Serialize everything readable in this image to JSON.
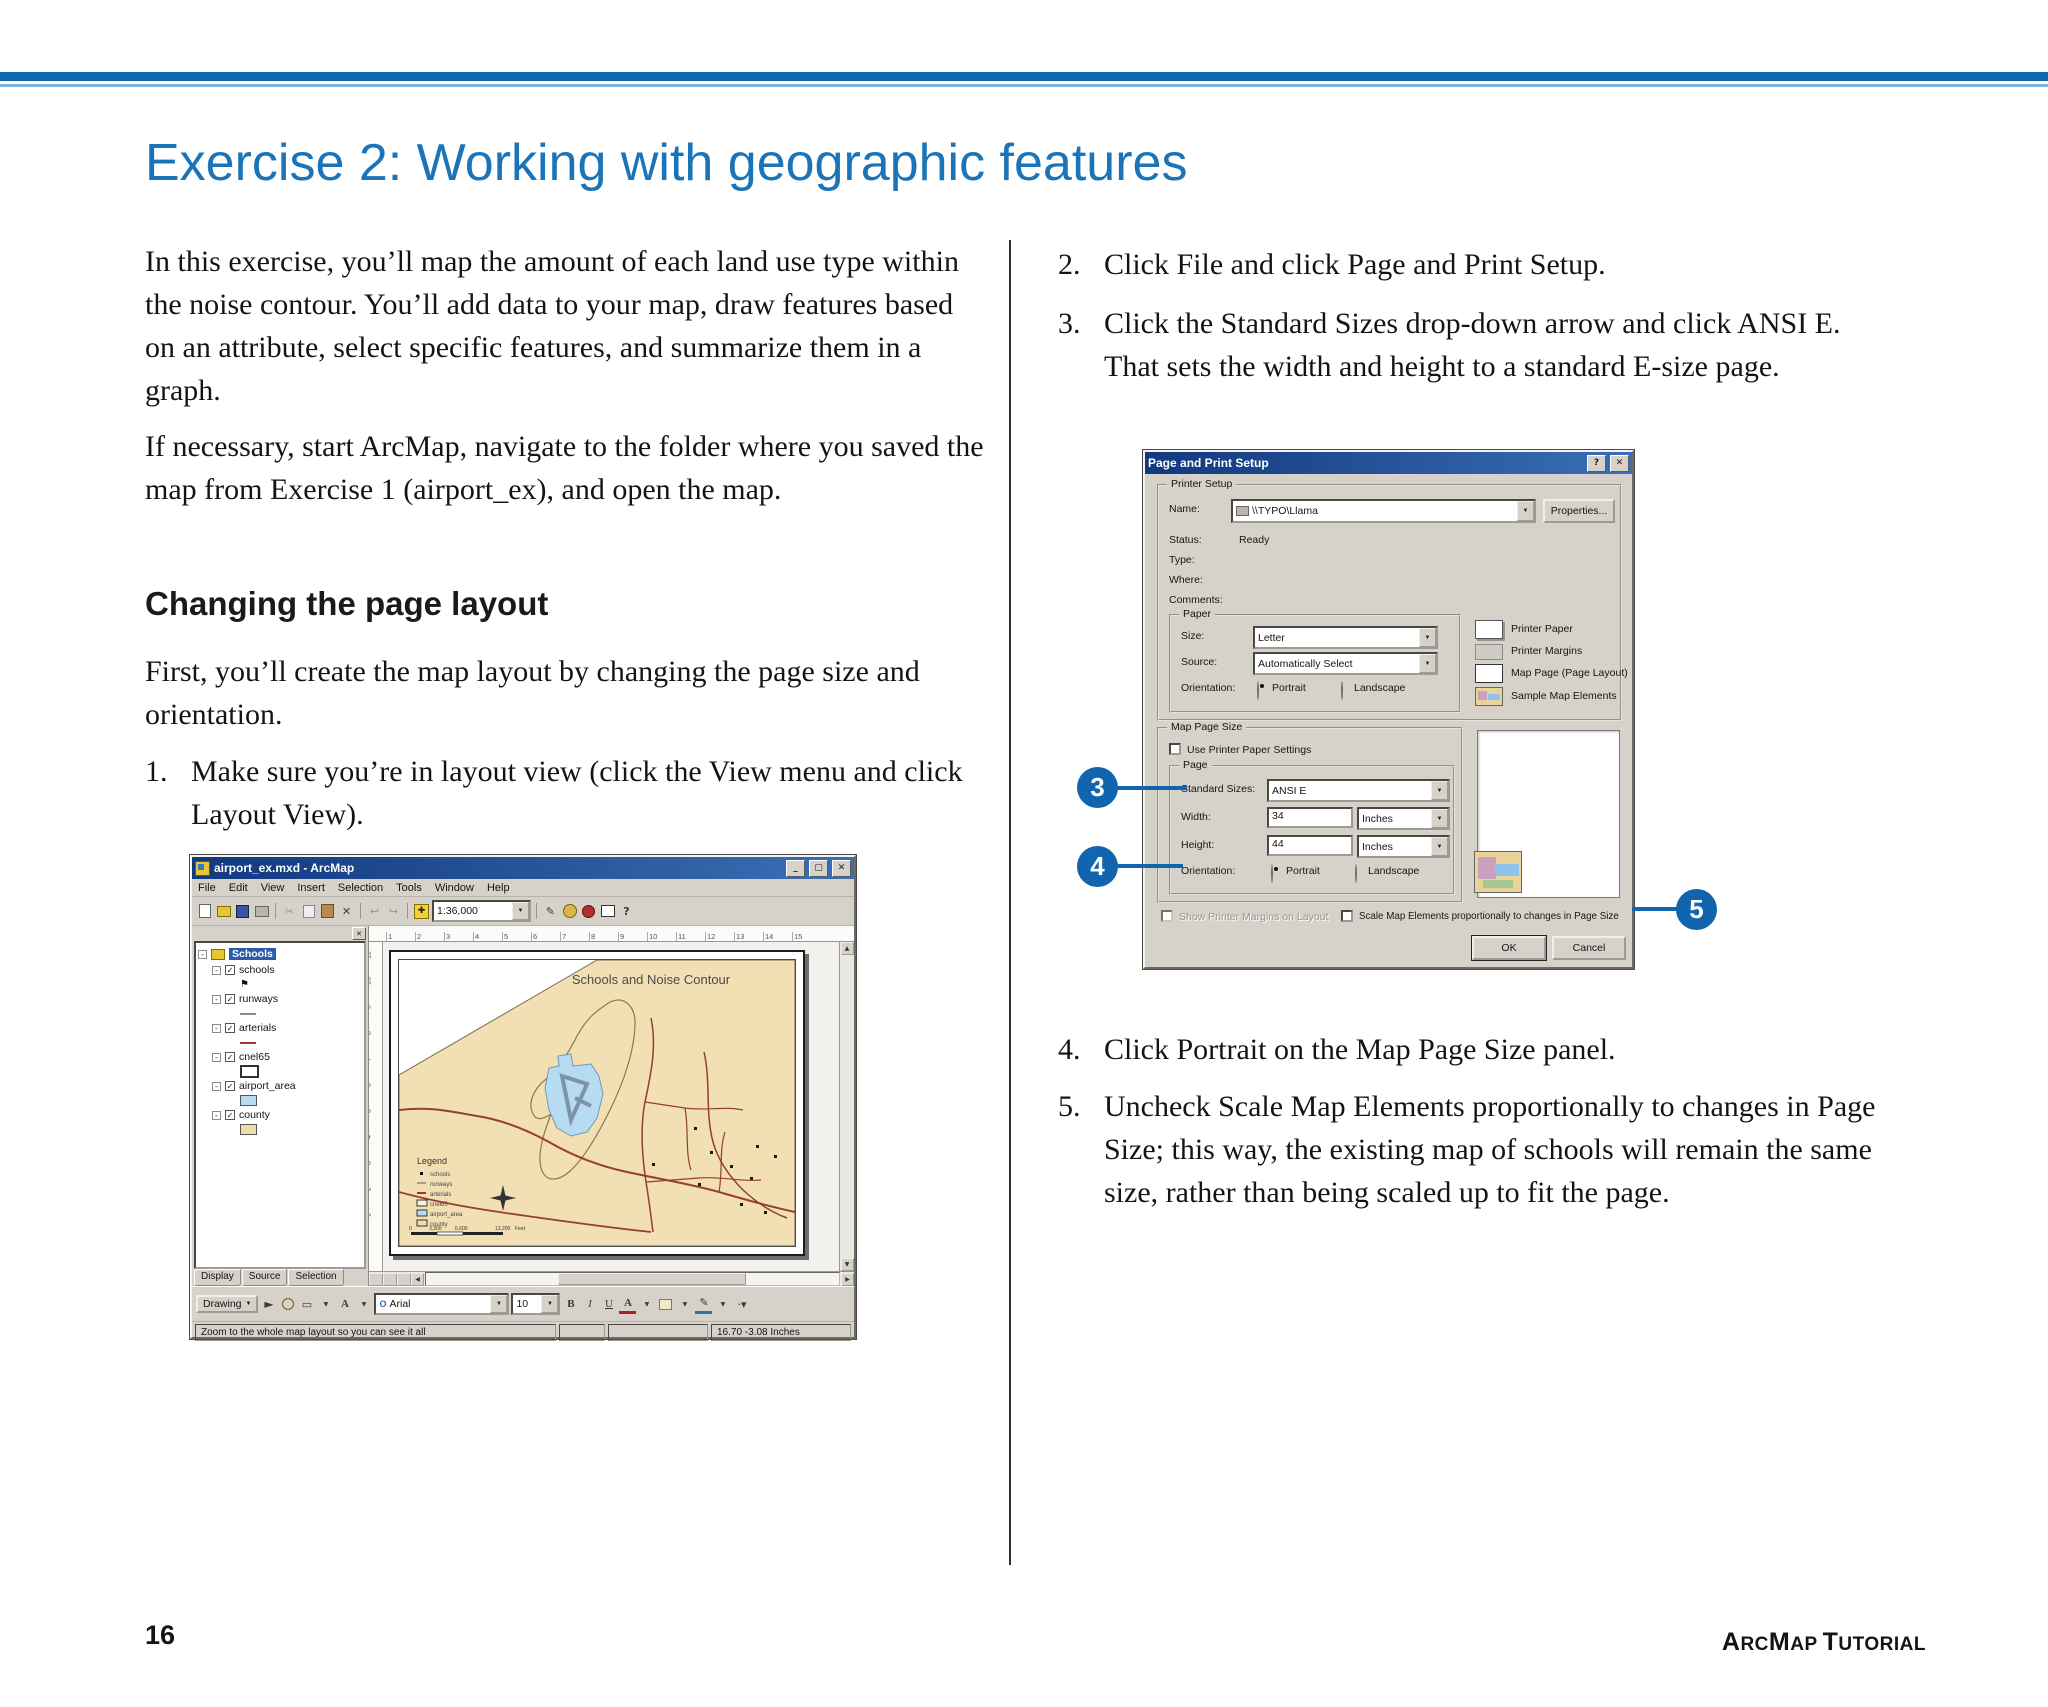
{
  "colors": {
    "accent_blue": "#1b74b8",
    "rule_blue": "#0f68af",
    "rule_light_blue": "#7fb4de",
    "callout_blue": "#1065ae",
    "dialog_titlebar": "#12387e",
    "map_tan": "#f3dfb4",
    "airport_blue": "#b7dbf2",
    "road_red": "#93402c"
  },
  "header": {
    "title": "Exercise 2: Working with geographic features"
  },
  "left_column": {
    "para1": "In this exercise, you’ll map the amount of each land use type within the noise contour. You’ll add data to your map, draw features based on an attribute, select specific features, and summarize them in a graph.",
    "para2": "If necessary, start ArcMap, navigate to the folder where you saved the map from Exercise 1 (airport_ex), and open the map.",
    "heading": "Changing the page layout",
    "para3": "First, you’ll create the map layout by changing the page size and orientation.",
    "step1_num": "1.",
    "step1": "Make sure you’re in layout view (click the View menu and click Layout View)."
  },
  "right_column": {
    "step2_num": "2.",
    "step2": "Click File and click Page and Print Setup.",
    "step3_num": "3.",
    "step3": "Click the Standard Sizes drop-down arrow and click ANSI E. That sets the width and height to a standard E-size page.",
    "step4_num": "4.",
    "step4": "Click Portrait on the Map Page Size panel.",
    "step5_num": "5.",
    "step5": "Uncheck Scale Map Elements proportionally to changes in Page Size; this way, the existing map of schools will remain the same size, rather than being scaled up to fit the page."
  },
  "callouts": {
    "c3": "3",
    "c4": "4",
    "c5": "5"
  },
  "icons": {
    "minimize": "_",
    "maximize": "▢",
    "close": "✕",
    "help": "?",
    "dropdown": "▼",
    "check": "✓",
    "collapse": "-",
    "scissors": "✂",
    "delete": "✕",
    "undo": "↩",
    "redo": "↪",
    "add_plus": "✚",
    "pencil": "✎",
    "pointer": "►",
    "up": "▲",
    "down": "▼",
    "left": "◀",
    "right": "▶",
    "font_o": "O",
    "text_a": "A",
    "rect": "▭",
    "flag": "⚑",
    "dots": "·▾"
  },
  "arcmap": {
    "title": "airport_ex.mxd - ArcMap",
    "menus": [
      "File",
      "Edit",
      "View",
      "Insert",
      "Selection",
      "Tools",
      "Window",
      "Help"
    ],
    "scale": "1:36,000",
    "toc": {
      "root": "Schools",
      "layers": [
        "schools",
        "runways",
        "arterials",
        "cnel65",
        "airport_area",
        "county"
      ],
      "tabs": [
        "Display",
        "Source",
        "Selection"
      ]
    },
    "ruler_top": [
      "1",
      "2",
      "3",
      "4",
      "5",
      "6",
      "7",
      "8",
      "9",
      "10",
      "11",
      "12",
      "13",
      "14",
      "15"
    ],
    "ruler_left": [
      "11",
      "10",
      "9",
      "8",
      "7",
      "6",
      "5",
      "4",
      "3",
      "2",
      "1"
    ],
    "map": {
      "title": "Schools and Noise Contour",
      "legend_title": "Legend",
      "legend_items": [
        "schools",
        "runways",
        "arterials",
        "cnel65",
        "airport_area",
        "county"
      ],
      "scalebar": [
        "0",
        "3,300",
        "6,600",
        "13,200",
        "Feet"
      ]
    },
    "drawing": {
      "label": "Drawing",
      "font": "Arial",
      "size": "10",
      "bold": "B",
      "italic": "I",
      "underline": "U"
    },
    "status_left": "Zoom to the whole map layout so you can see it all",
    "status_right": "16.70 -3.08 Inches"
  },
  "dialog": {
    "title": "Page and Print Setup",
    "printer_setup": {
      "label": "Printer Setup",
      "name_label": "Name:",
      "name_value": "\\\\TYPO\\Llama",
      "properties": "Properties...",
      "status_label": "Status:",
      "status_value": "Ready",
      "type_label": "Type:",
      "where_label": "Where:",
      "comments_label": "Comments:",
      "paper": {
        "label": "Paper",
        "size_label": "Size:",
        "size_value": "Letter",
        "source_label": "Source:",
        "source_value": "Automatically Select",
        "orientation_label": "Orientation:",
        "portrait": "Portrait",
        "landscape": "Landscape"
      },
      "legend": [
        "Printer Paper",
        "Printer Margins",
        "Map Page (Page Layout)",
        "Sample Map Elements"
      ]
    },
    "map_page_size": {
      "label": "Map Page Size",
      "use_printer": "Use Printer Paper Settings",
      "page": {
        "label": "Page",
        "standard_sizes_label": "Standard Sizes:",
        "standard_sizes_value": "ANSI E",
        "width_label": "Width:",
        "width_value": "34",
        "height_label": "Height:",
        "height_value": "44",
        "units": "Inches",
        "orientation_label": "Orientation:",
        "portrait": "Portrait",
        "landscape": "Landscape"
      }
    },
    "show_margins": "Show Printer Margins on Layout",
    "scale_elements": "Scale Map Elements proportionally to changes in Page Size",
    "ok": "OK",
    "cancel": "Cancel"
  },
  "footer": {
    "page_number": "16",
    "brand_parts": {
      "a1": "A",
      "a2": "RC",
      "m1": "M",
      "m2": "AP",
      "t1": "T",
      "t2": "UTORIAL"
    }
  }
}
